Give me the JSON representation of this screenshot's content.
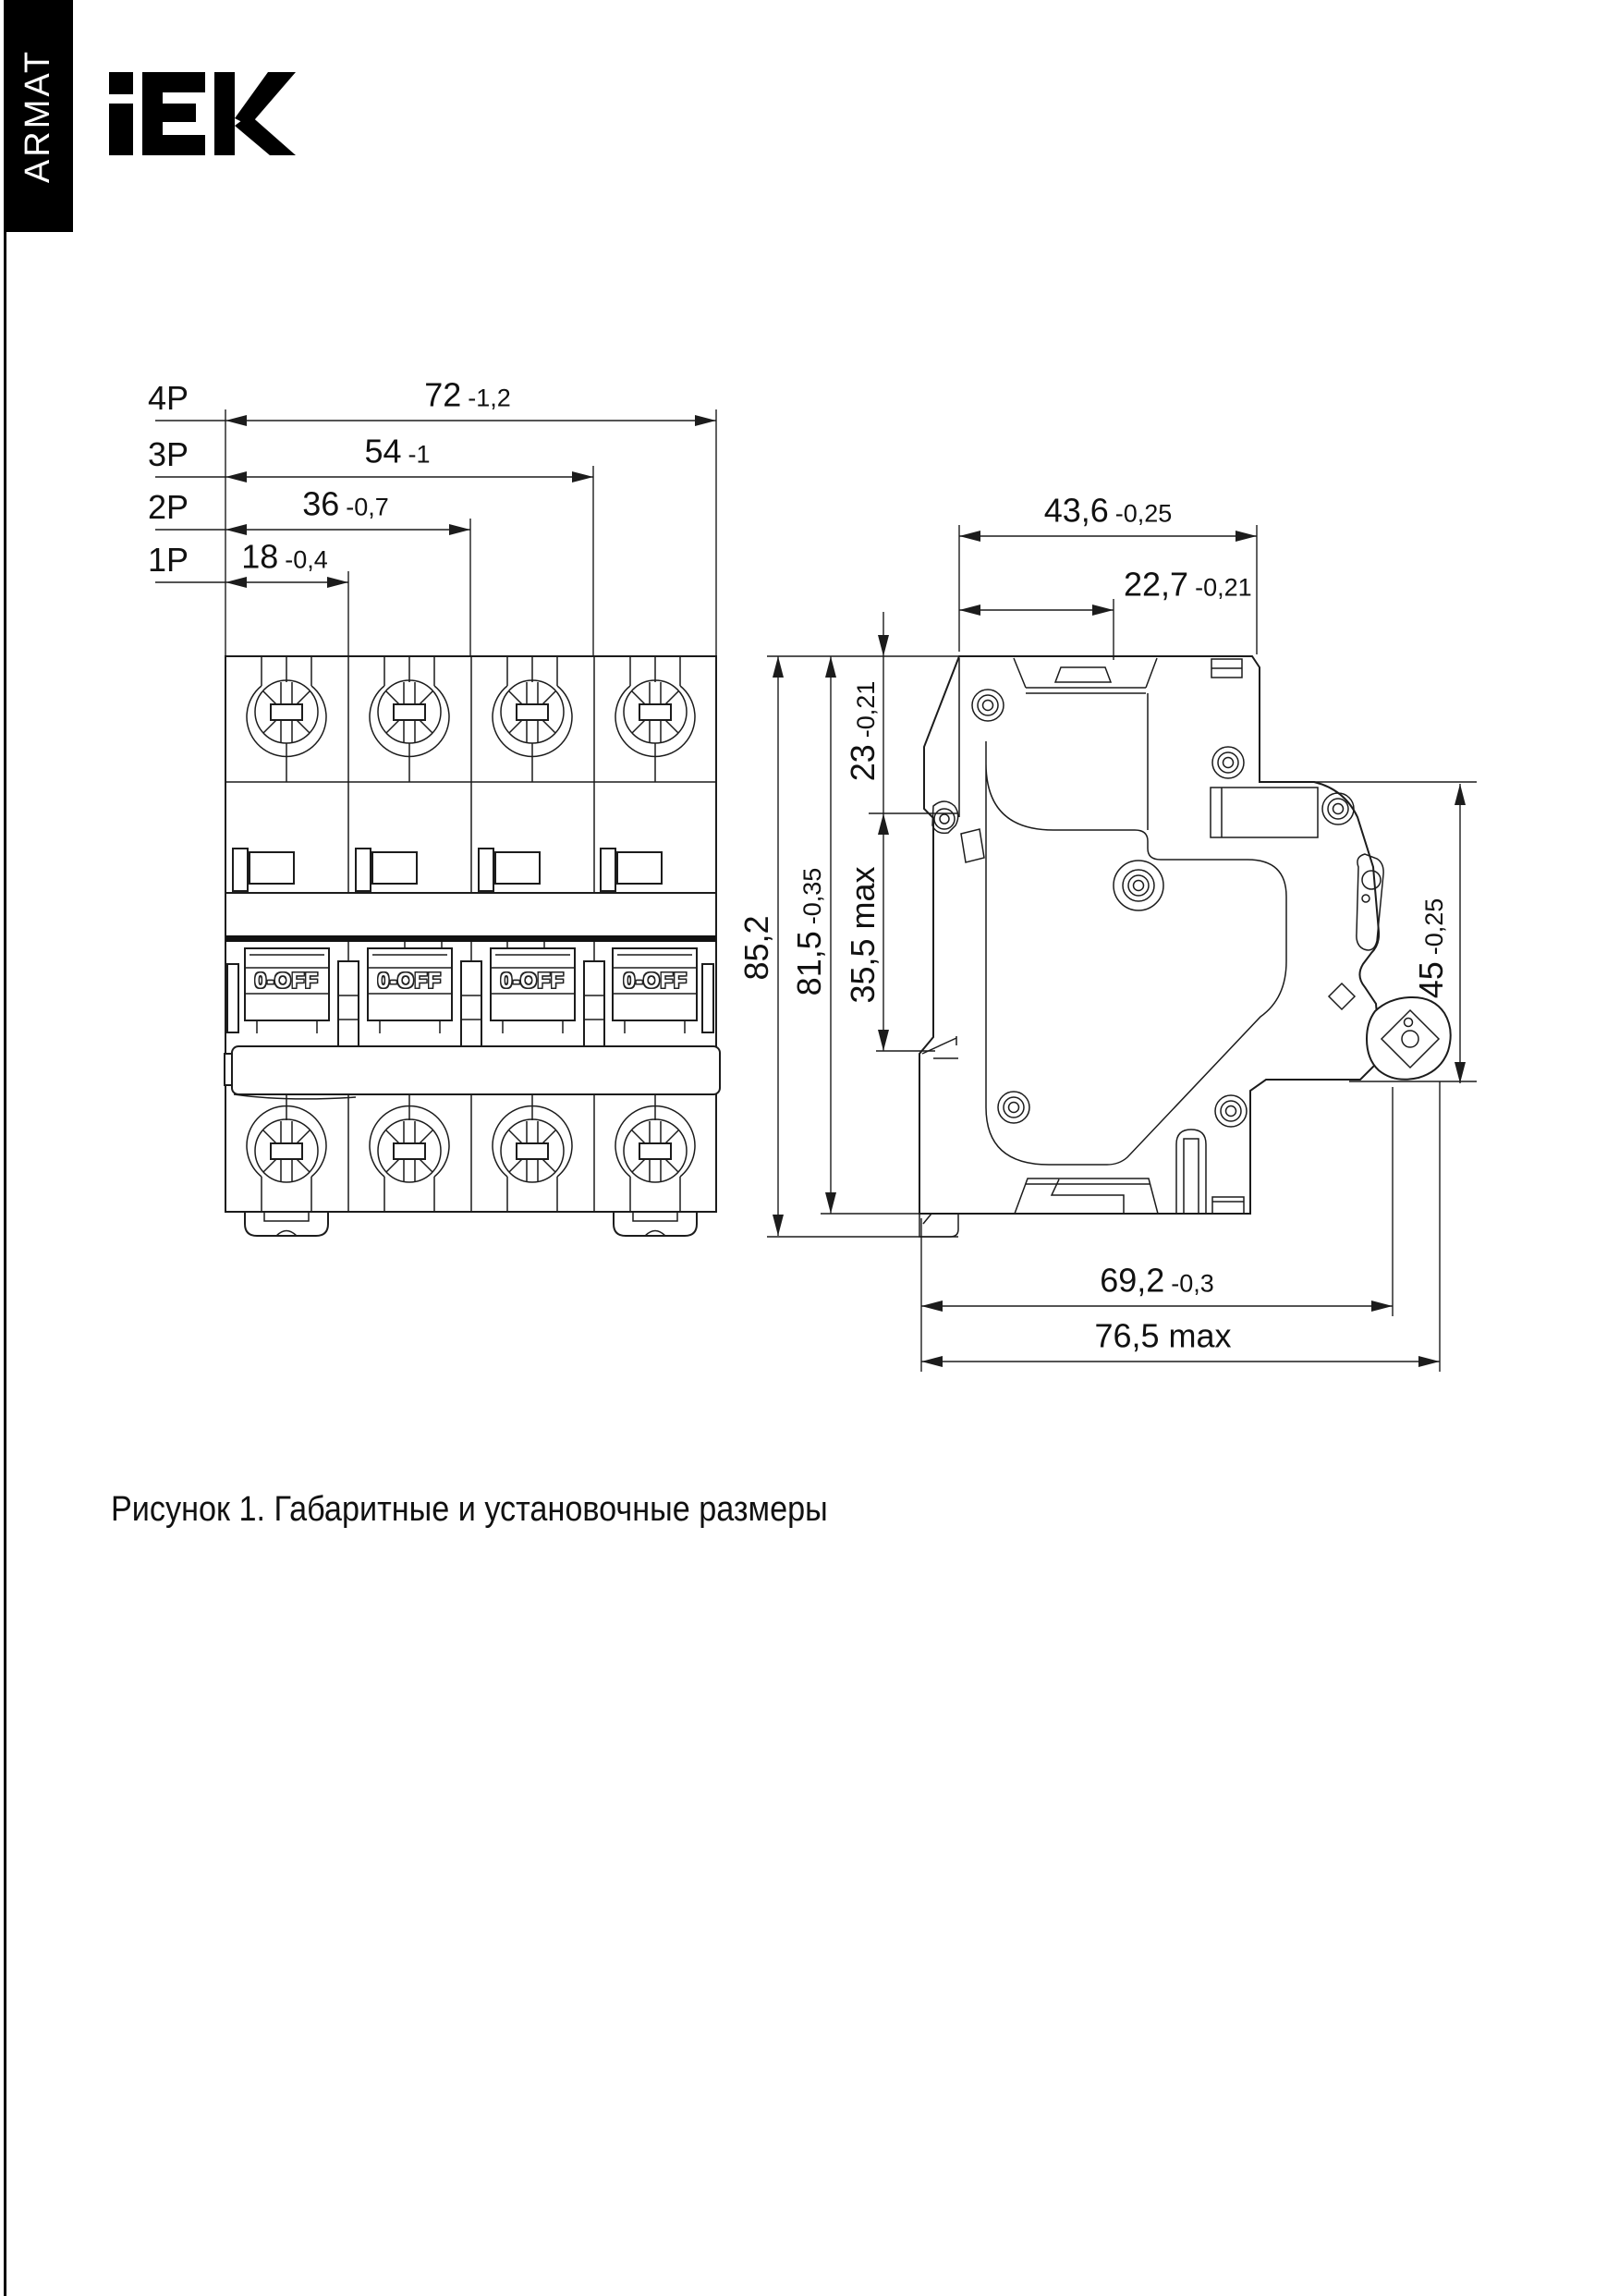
{
  "brand": {
    "badge": "ARMAT",
    "logo": "IEK"
  },
  "caption": "Рисунок 1. Габаритные и установочные размеры",
  "front_view": {
    "rows": [
      {
        "label": "4P",
        "value": "72",
        "tol": "-1,2"
      },
      {
        "label": "3P",
        "value": "54",
        "tol": "-1"
      },
      {
        "label": "2P",
        "value": "36",
        "tol": "-0,7"
      },
      {
        "label": "1P",
        "value": "18",
        "tol": "-0,4"
      }
    ],
    "toggle_label": "0-OFF"
  },
  "side_view": {
    "top_width": {
      "value": "43,6",
      "tol": "-0,25"
    },
    "handle_offset": {
      "value": "22,7",
      "tol": "-0,21"
    },
    "front_depth": {
      "value": "23",
      "tol": "-0,21"
    },
    "mid_depth": {
      "value": "35,5 max",
      "tol": ""
    },
    "body_height": {
      "value": "81,5",
      "tol": "-0,35"
    },
    "total_height": {
      "value": "85,2",
      "tol": ""
    },
    "panel_height": {
      "value": "45",
      "tol": "-0,25"
    },
    "mount_depth": {
      "value": "69,2",
      "tol": "-0,3"
    },
    "max_depth": {
      "value": "76,5 max",
      "tol": ""
    }
  }
}
